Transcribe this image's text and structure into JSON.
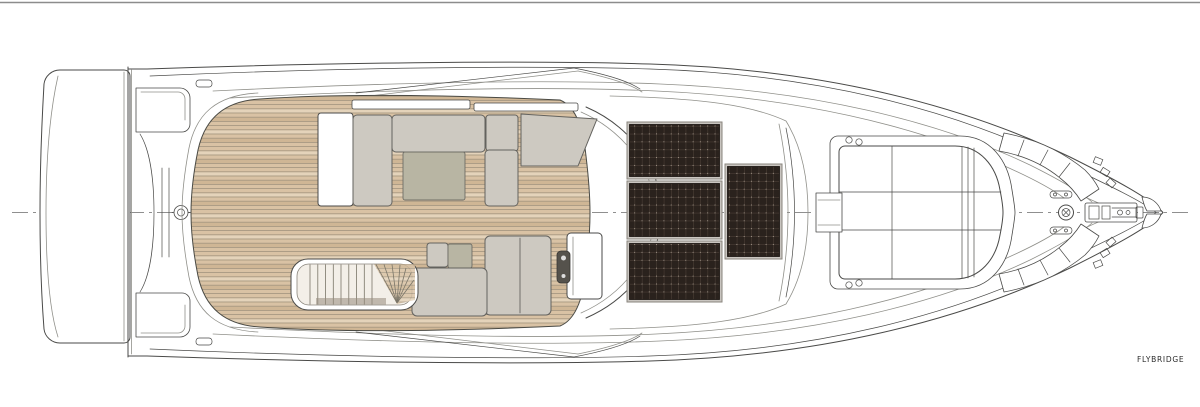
{
  "label": "FLYBRIDGE",
  "deck_plan": {
    "level_name": "FLYBRIDGE",
    "orientation": "bow to the right, stern to the left",
    "visible_areas": [
      "swim platform",
      "transom garage",
      "aft teak deck",
      "port lounge sofa with table",
      "starboard sofa with table",
      "staircase to lower deck",
      "helm console",
      "hardtop with solar panels",
      "bow sunpad",
      "bow curved benches",
      "anchor windlass"
    ],
    "solar_panels": {
      "count": 4,
      "stacked_left": 3,
      "offset_right": 1
    },
    "tables": 2,
    "has_staircase": true,
    "centerline_style": "dash-dot"
  },
  "colors": {
    "paper": "#ffffff",
    "line": "#4a4a48",
    "line-light": "#90908a",
    "teak": "#d9c2a4",
    "teak-light": "#e4d3ba",
    "teak-dark": "#cfb695",
    "teak-seam": "#a2947e",
    "upholstery": "#cdc9c1",
    "upholstery-edge": "#63625e",
    "table": "#b8b5a3",
    "solar": "#2a221d",
    "solar-grid": "#5a4c42",
    "solar-frame": "#c9c5c0"
  }
}
